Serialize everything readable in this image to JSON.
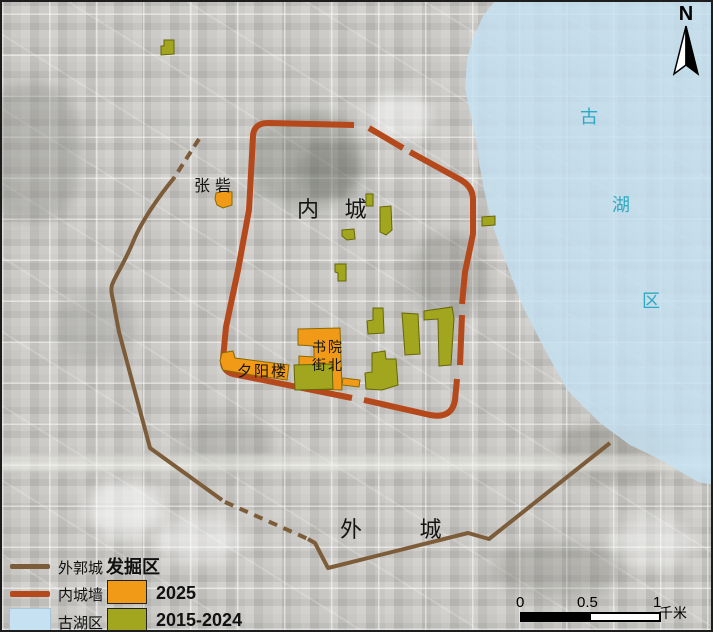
{
  "map": {
    "north": "N",
    "labels": {
      "zhangzhai": "张砦",
      "inner_city": "内 城",
      "outer_city": "外 城",
      "shuyuan_line1": "书院",
      "shuyuan_line2": "街北",
      "xiyanglou": "夕阳楼",
      "lake_char1": "古",
      "lake_char2": "湖",
      "lake_char3": "区"
    }
  },
  "legend": {
    "title": "发掘区",
    "outer_wall": "外郭城",
    "inner_wall": "内城墙",
    "lake": "古湖区",
    "y2025": "2025",
    "y2015_2024": "2015-2024"
  },
  "scale": {
    "t0": "0",
    "t05": "0.5",
    "t1": "1",
    "unit": "千米"
  },
  "colors": {
    "inner_wall": "#b5491b",
    "outer_wall": "#7d5d39",
    "lake_fill": "#c5e1f2",
    "lake_text": "#2da9c2",
    "excavation_2025": "#f09a18",
    "excavation_2015_2024": "#a2a51e"
  }
}
